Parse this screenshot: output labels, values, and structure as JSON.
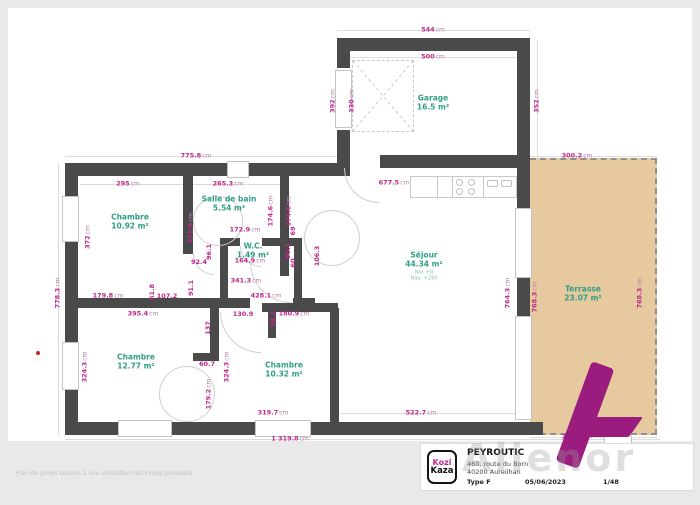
{
  "page": {
    "disclaimer": "Plan de projet soumis à une validation technique préalable",
    "watermark": "Alienor"
  },
  "title_block": {
    "client": "PEYROUTIC",
    "address_line1": "460, route du Born",
    "address_line2": "40200 Aureilhan",
    "type_label": "Type F",
    "date": "05/06/2023",
    "scale": "1/48",
    "logo_line1": "Kozi",
    "logo_line2": "Kaza"
  },
  "colors": {
    "dimension_text": "#c0268c",
    "room_text": "#2f9e85",
    "wall": "#4a4a4b",
    "terrace_fill": "#e7c9a0",
    "brand_purple": "#9a1c7f"
  },
  "rooms": [
    {
      "name": "Garage",
      "area": "16.5 m²",
      "x": 433,
      "y": 103
    },
    {
      "name": "Chambre",
      "area": "10.92 m²",
      "x": 130,
      "y": 222
    },
    {
      "name": "Salle de bain",
      "area": "5.54 m²",
      "x": 229,
      "y": 204
    },
    {
      "name": "W.C.",
      "area": "1.49 m²",
      "x": 253,
      "y": 251
    },
    {
      "name": "Séjour",
      "area": "44.34 m²",
      "x": 424,
      "y": 266,
      "sub": [
        "Niv. +0",
        "Hau. +250"
      ]
    },
    {
      "name": "Terrasse",
      "area": "23.07 m²",
      "x": 583,
      "y": 294
    },
    {
      "name": "Chambre",
      "area": "12.77 m²",
      "x": 136,
      "y": 362
    },
    {
      "name": "Chambre",
      "area": "10.32 m²",
      "x": 284,
      "y": 370
    }
  ],
  "dimensions": [
    {
      "t": "544cm",
      "x": 433,
      "y": 30
    },
    {
      "t": "500cm",
      "x": 433,
      "y": 57
    },
    {
      "t": "392cm",
      "x": 333,
      "y": 101,
      "v": 1
    },
    {
      "t": "330cm",
      "x": 352,
      "y": 101,
      "v": 1
    },
    {
      "t": "352cm",
      "x": 537,
      "y": 101,
      "v": 1
    },
    {
      "t": "775.8cm",
      "x": 196,
      "y": 156
    },
    {
      "t": "295cm",
      "x": 128,
      "y": 184
    },
    {
      "t": "265.3cm",
      "x": 228,
      "y": 184
    },
    {
      "t": "372cm",
      "x": 88,
      "y": 237,
      "v": 1
    },
    {
      "t": "272.9cm",
      "x": 191,
      "y": 228,
      "v": 1
    },
    {
      "t": "174.6cm",
      "x": 271,
      "y": 211,
      "v": 1
    },
    {
      "t": "174.6cm",
      "x": 289,
      "y": 211,
      "v": 1
    },
    {
      "t": "172.9cm",
      "x": 245,
      "y": 230
    },
    {
      "t": "69",
      "x": 293,
      "y": 231,
      "v": 1
    },
    {
      "t": "677.5cm",
      "x": 394,
      "y": 183
    },
    {
      "t": "92.4",
      "x": 199,
      "y": 262
    },
    {
      "t": "96.1",
      "x": 209,
      "y": 252,
      "v": 1
    },
    {
      "t": "164.9cm",
      "x": 250,
      "y": 261
    },
    {
      "t": "90.1",
      "x": 288,
      "y": 251,
      "v": 1
    },
    {
      "t": "60",
      "x": 293,
      "y": 263,
      "v": 1
    },
    {
      "t": "106.3",
      "x": 317,
      "y": 256,
      "v": 1
    },
    {
      "t": "341.3cm",
      "x": 246,
      "y": 281
    },
    {
      "t": "428.1cm",
      "x": 266,
      "y": 296
    },
    {
      "t": "179.8cm",
      "x": 108,
      "y": 296
    },
    {
      "t": "61.8",
      "x": 152,
      "y": 292,
      "v": 1
    },
    {
      "t": "107.2",
      "x": 167,
      "y": 296
    },
    {
      "t": "91.1",
      "x": 191,
      "y": 288,
      "v": 1
    },
    {
      "t": "395.4cm",
      "x": 143,
      "y": 314
    },
    {
      "t": "130.9",
      "x": 243,
      "y": 314
    },
    {
      "t": "58.3",
      "x": 273,
      "y": 319,
      "v": 1
    },
    {
      "t": "180.9cm",
      "x": 294,
      "y": 314
    },
    {
      "t": "137",
      "x": 208,
      "y": 328,
      "v": 1
    },
    {
      "t": "324.3cm",
      "x": 85,
      "y": 367,
      "v": 1
    },
    {
      "t": "60.7",
      "x": 207,
      "y": 364
    },
    {
      "t": "324.3cm",
      "x": 227,
      "y": 367,
      "v": 1
    },
    {
      "t": "179.2cm",
      "x": 209,
      "y": 394,
      "v": 1
    },
    {
      "t": "319.7cm",
      "x": 273,
      "y": 413
    },
    {
      "t": "522.7cm",
      "x": 421,
      "y": 413
    },
    {
      "t": "1 319.8cm",
      "x": 290,
      "y": 439
    },
    {
      "t": "778.3cm",
      "x": 58,
      "y": 293,
      "v": 1
    },
    {
      "t": "764.3cm",
      "x": 508,
      "y": 293,
      "v": 1
    },
    {
      "t": "768.3cm",
      "x": 535,
      "y": 297,
      "v": 1
    },
    {
      "t": "300.2cm",
      "x": 577,
      "y": 156
    },
    {
      "t": "768.3cm",
      "x": 640,
      "y": 293,
      "v": 1
    },
    {
      "t": "300.3cm",
      "x": 577,
      "y": 437
    }
  ]
}
